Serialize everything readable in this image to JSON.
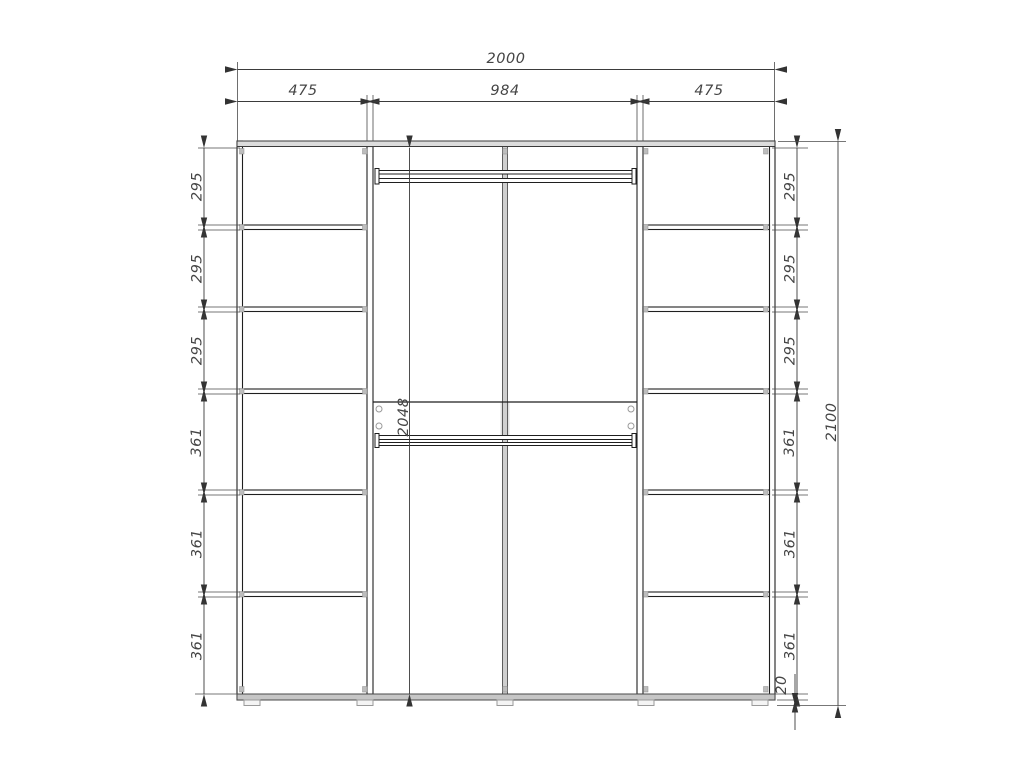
{
  "drawing": {
    "type": "technical-drawing",
    "subject": "wardrobe front elevation",
    "units": "mm",
    "width_dims": {
      "total": "2000",
      "left_section": "475",
      "center_section": "984",
      "right_section": "475"
    },
    "height_dims": {
      "center_interior": "2048",
      "total": "2100",
      "base": "20"
    },
    "left_column": [
      "295",
      "295",
      "295",
      "361",
      "361",
      "361"
    ],
    "right_column": [
      "295",
      "295",
      "295",
      "361",
      "361",
      "361"
    ]
  }
}
